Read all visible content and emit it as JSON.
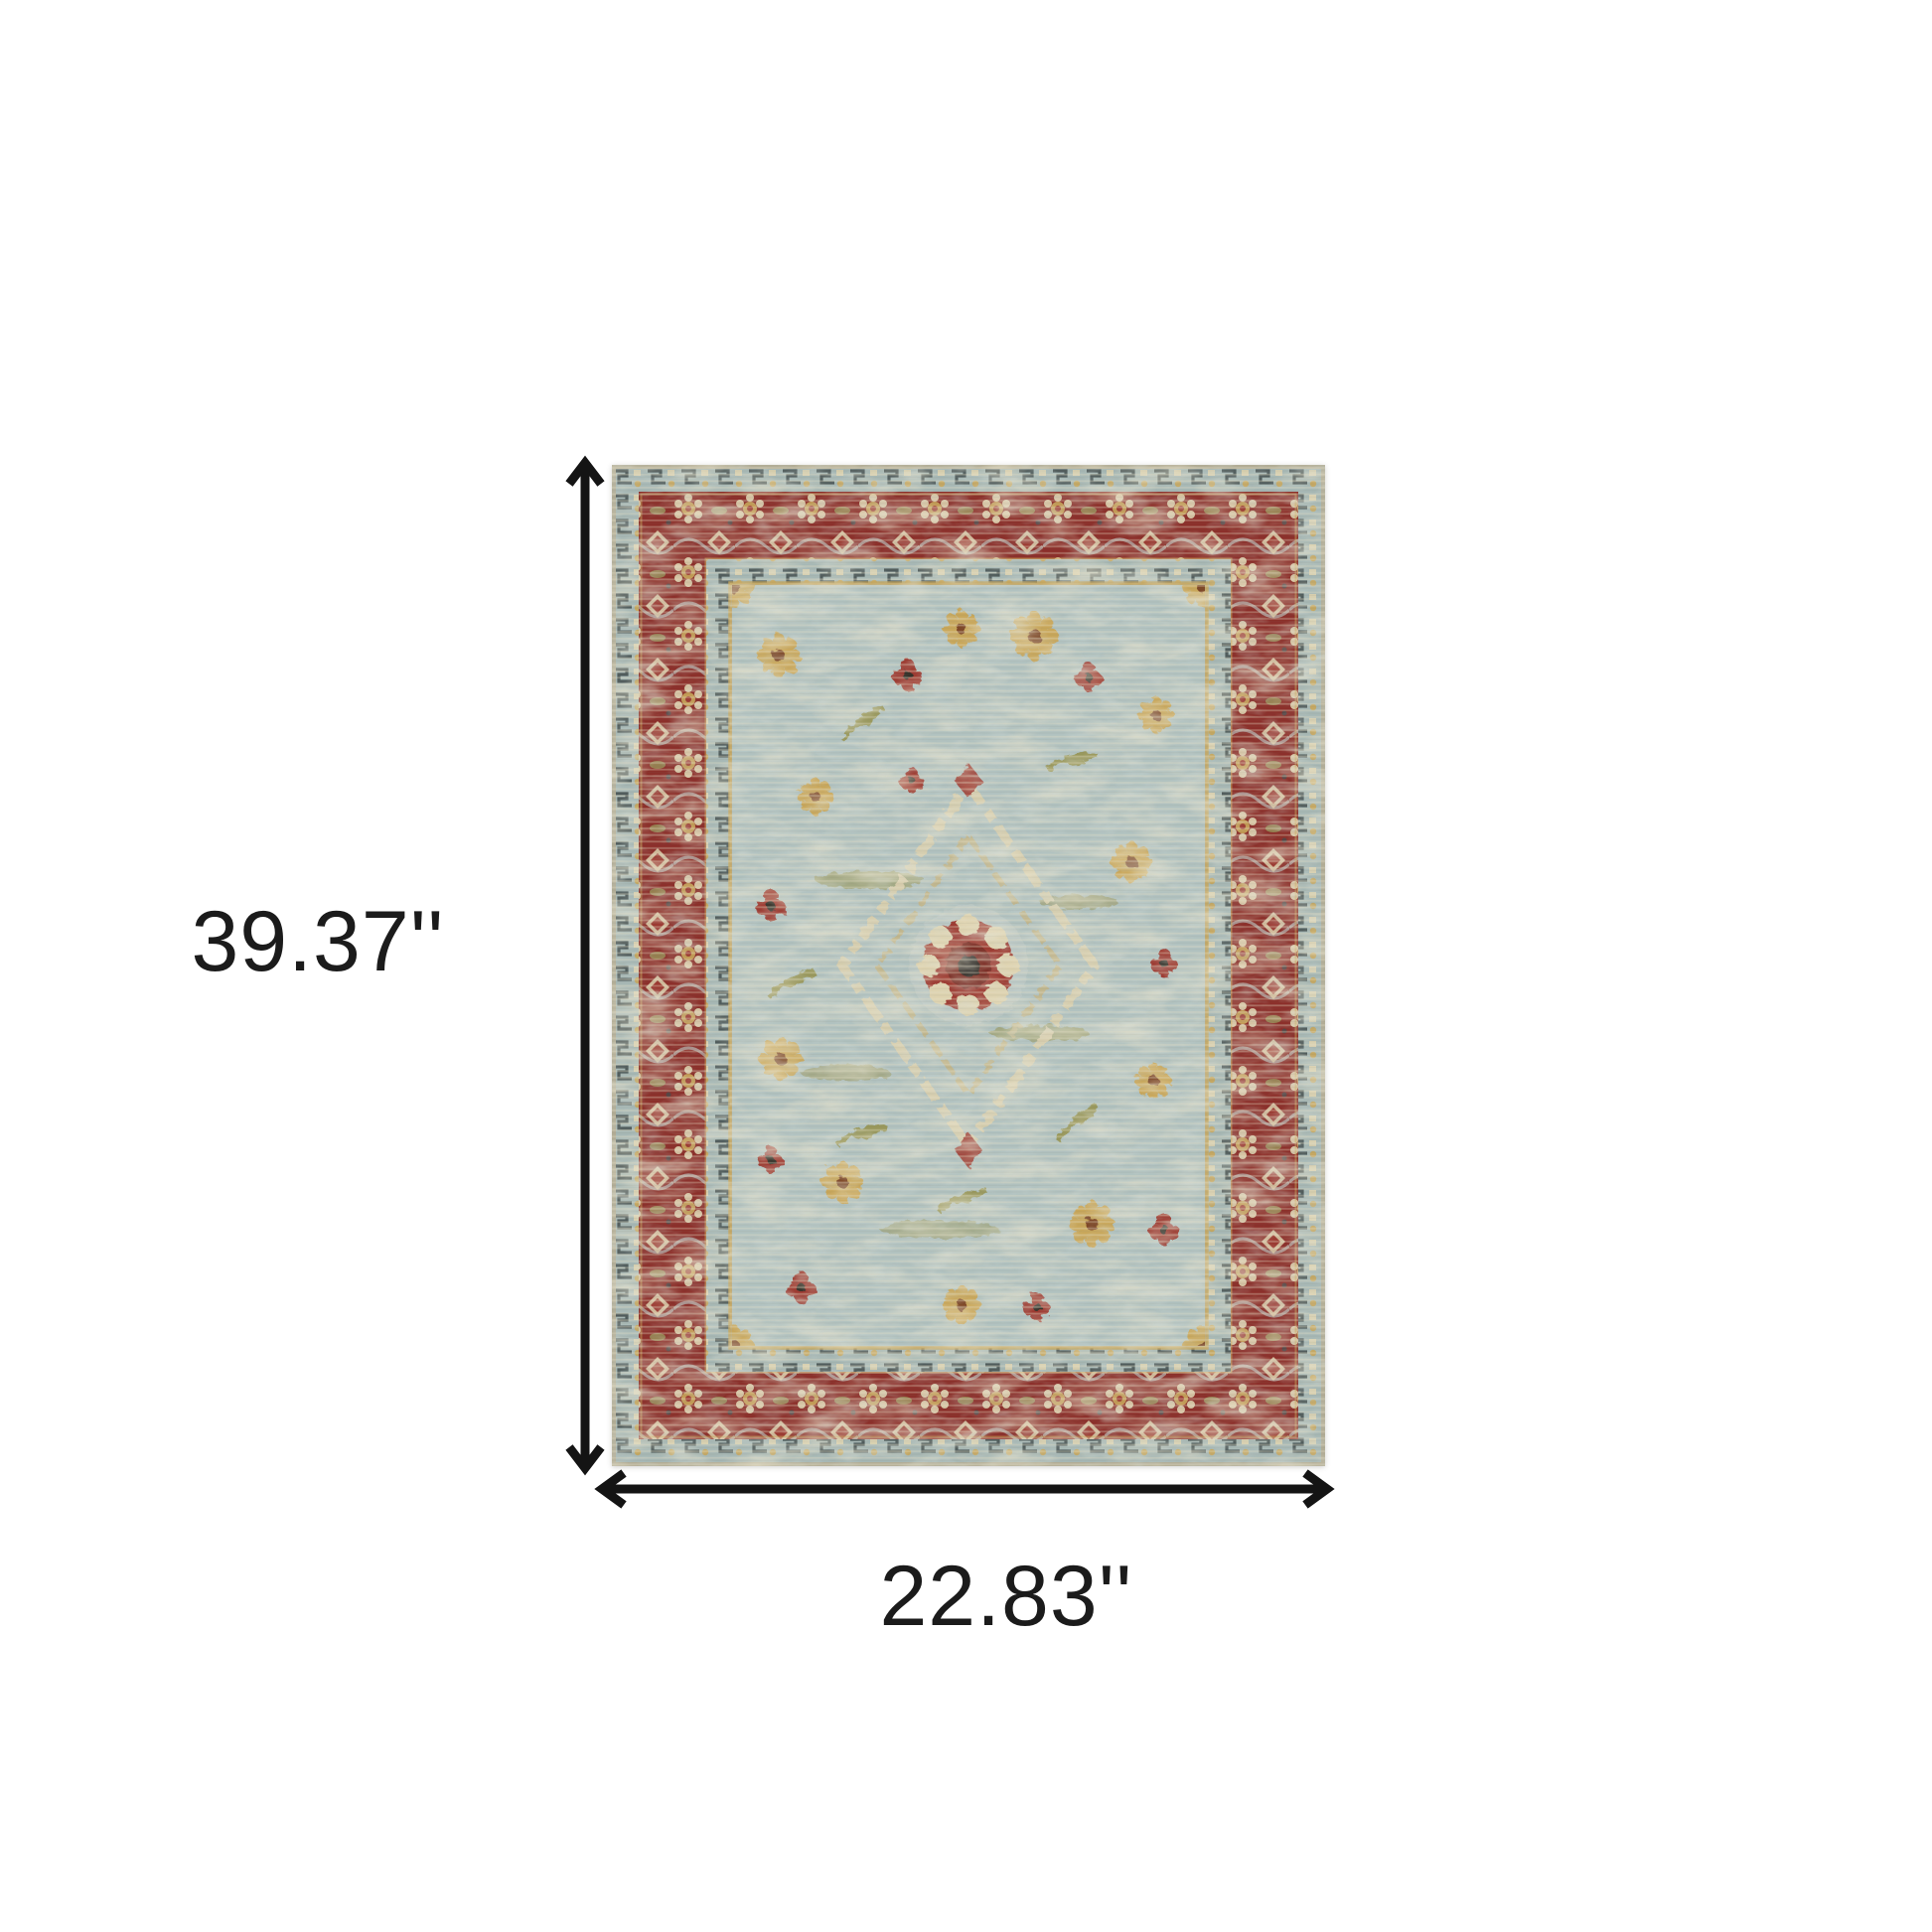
{
  "diagram": {
    "height_label": "39.37''",
    "width_label": "22.83''"
  },
  "style": {
    "background": "#ffffff",
    "arrow_color": "#141414",
    "label_color": "#1b1b1b"
  },
  "rug": {
    "description": "Distressed vintage oriental area rug: blue-grey field with gold and red floral rosettes, central medallion, wide maroon floral border with blue-grey guard bands",
    "palette": {
      "field": "#b1c2c0",
      "guard": "#a7b8b5",
      "border_red": "#8c2f2a",
      "gold": "#c9a75a",
      "cream": "#ded3b0",
      "dark": "#414c4d",
      "selvage": "#b2ad96",
      "accent_red": "#9e3a32",
      "olive": "#99985c"
    }
  }
}
